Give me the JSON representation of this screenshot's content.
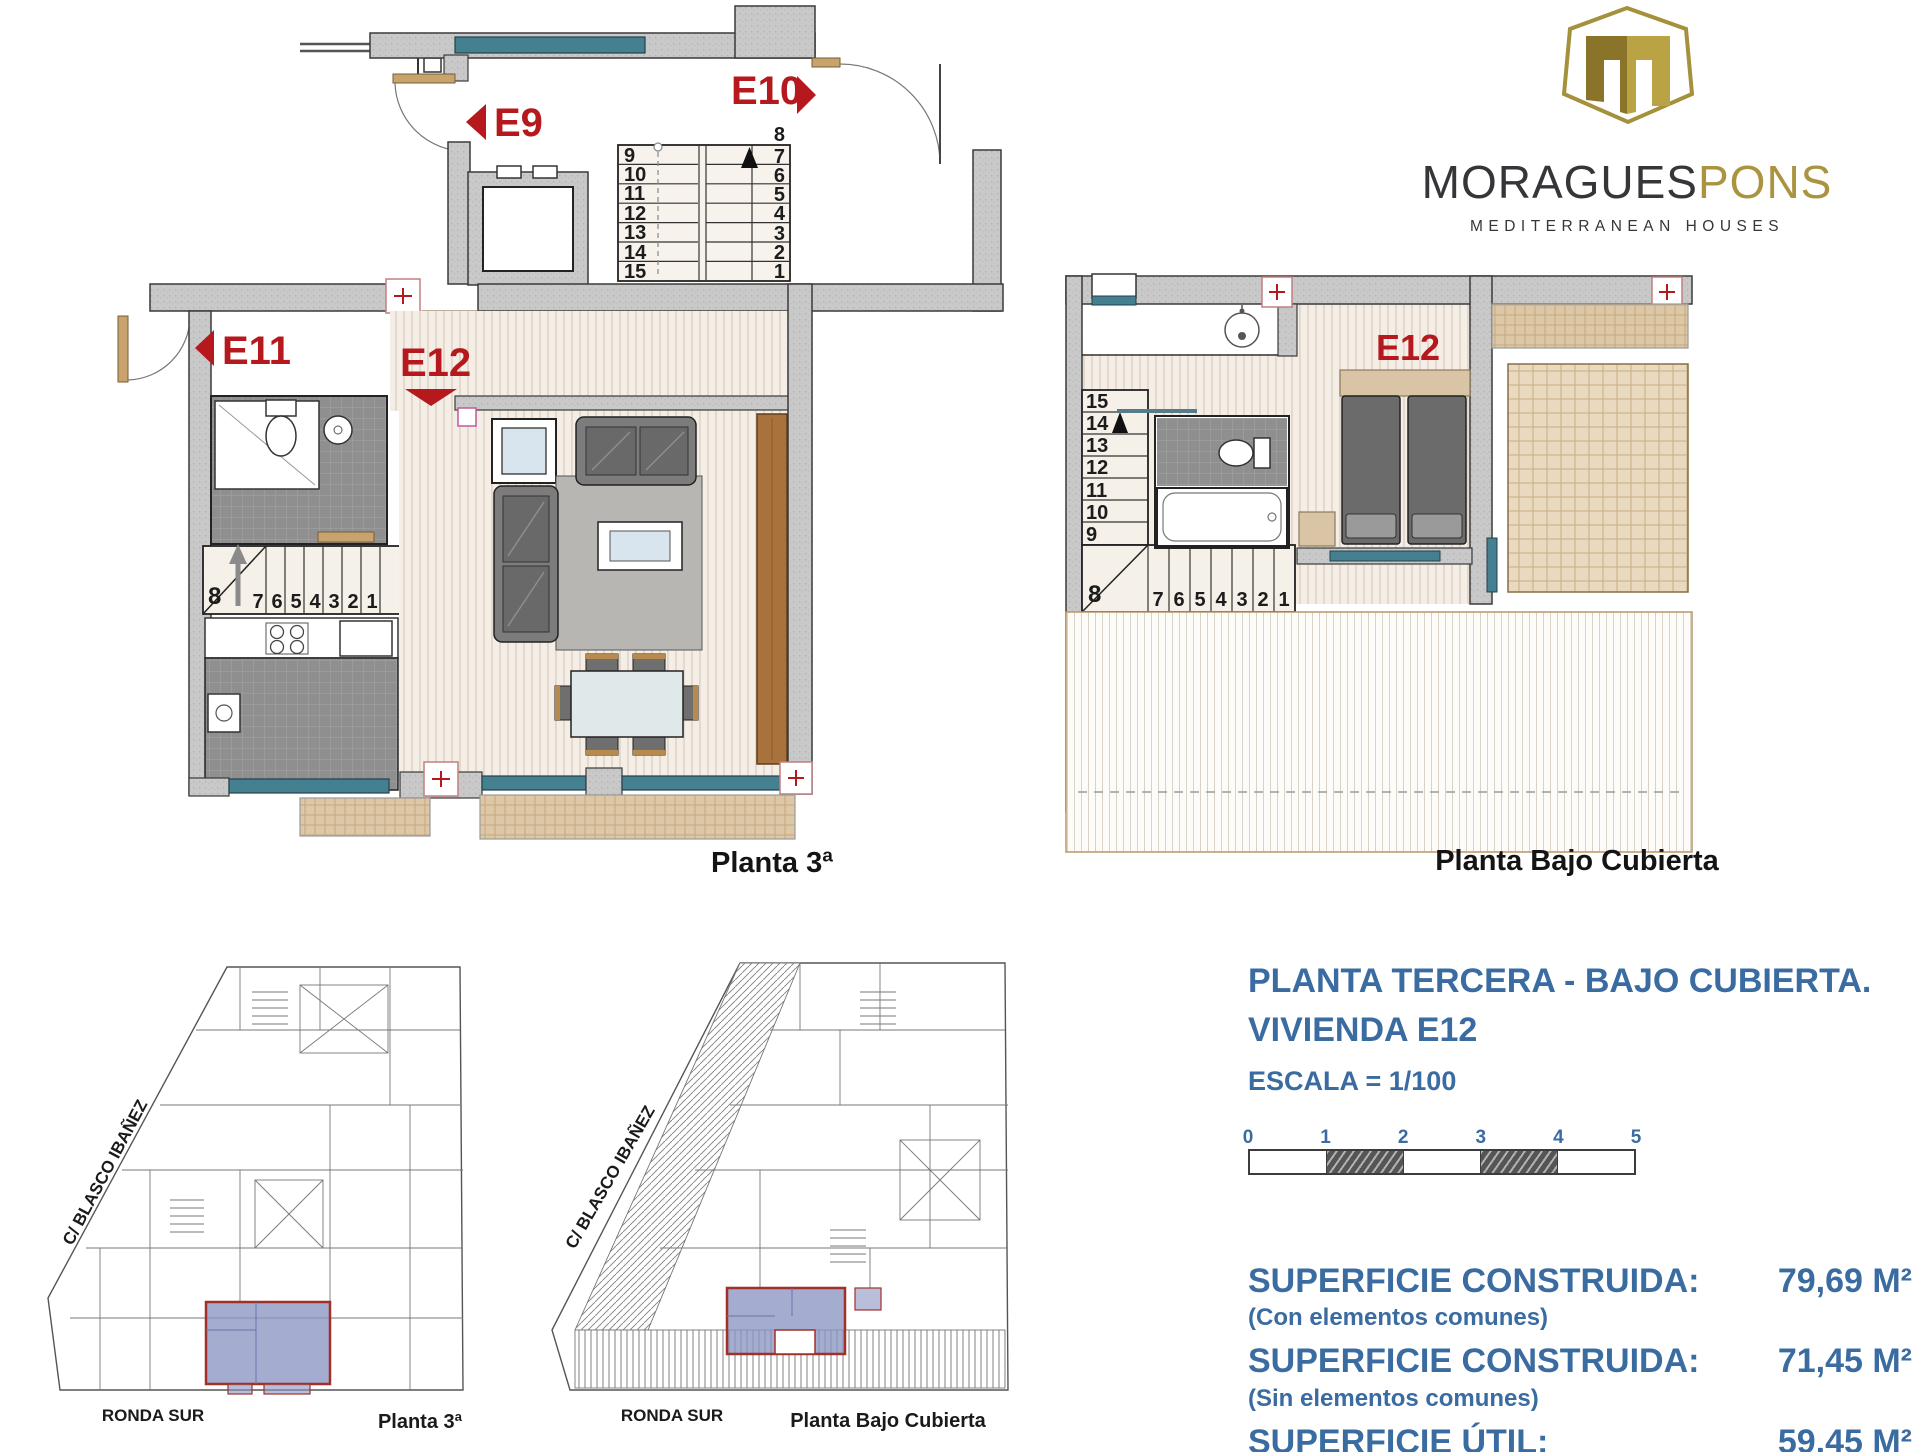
{
  "logo": {
    "brand_primary": "MORAGUES",
    "brand_secondary": "PONS",
    "tagline": "MEDITERRANEAN HOUSES"
  },
  "plan3": {
    "caption": "Planta 3ª",
    "labels": {
      "e9": "E9",
      "e10": "E10",
      "e11": "E11",
      "e12": "E12"
    },
    "main_stairs": {
      "left": [
        "9",
        "10",
        "11",
        "12",
        "13",
        "14",
        "15"
      ],
      "left_last": "16",
      "right_first": "8",
      "right": [
        "7",
        "6",
        "5",
        "4",
        "3",
        "2",
        "1"
      ]
    },
    "unit_stairs": {
      "corner": "8",
      "steps": [
        "7",
        "6",
        "5",
        "4",
        "3",
        "2",
        "1"
      ]
    }
  },
  "plan_bc": {
    "caption": "Planta Bajo Cubierta",
    "label_e12": "E12",
    "stairs": {
      "upper": [
        "15",
        "14",
        "13",
        "12",
        "11",
        "10",
        "9"
      ],
      "corner": "8",
      "lower": [
        "7",
        "6",
        "5",
        "4",
        "3",
        "2",
        "1"
      ]
    }
  },
  "site_a": {
    "street_diagonal": "C/ BLASCO IBAÑEZ",
    "street_bottom": "RONDA SUR",
    "caption": "Planta 3ª"
  },
  "site_b": {
    "street_diagonal": "C/ BLASCO IBAÑEZ",
    "street_bottom": "RONDA SUR",
    "caption": "Planta Bajo Cubierta"
  },
  "info": {
    "title_line1": "PLANTA TERCERA - BAJO CUBIERTA.",
    "title_line2": "VIVIENDA E12",
    "scale_text": "ESCALA = 1/100",
    "scale_ticks": [
      "0",
      "1",
      "2",
      "3",
      "4",
      "5"
    ],
    "areas": [
      {
        "label": "SUPERFICIE CONSTRUIDA:",
        "value": "79,69 M²",
        "note": "(Con elementos comunes)"
      },
      {
        "label": "SUPERFICIE CONSTRUIDA:",
        "value": "71,45 M²",
        "note": "(Sin elementos comunes)"
      },
      {
        "label": "SUPERFICIE ÚTIL:",
        "value": "59,45 M²",
        "note": ""
      }
    ]
  },
  "colors": {
    "accent_blue": "#3a6ba1",
    "label_red": "#b5191e",
    "wall_gray": "#c9c9c9",
    "window_teal": "#44808f",
    "wood_tan": "#d9c3a0",
    "brand_gold": "#a5913b",
    "brand_dark": "#36363a",
    "highlight_blue": "#8b95c2"
  }
}
